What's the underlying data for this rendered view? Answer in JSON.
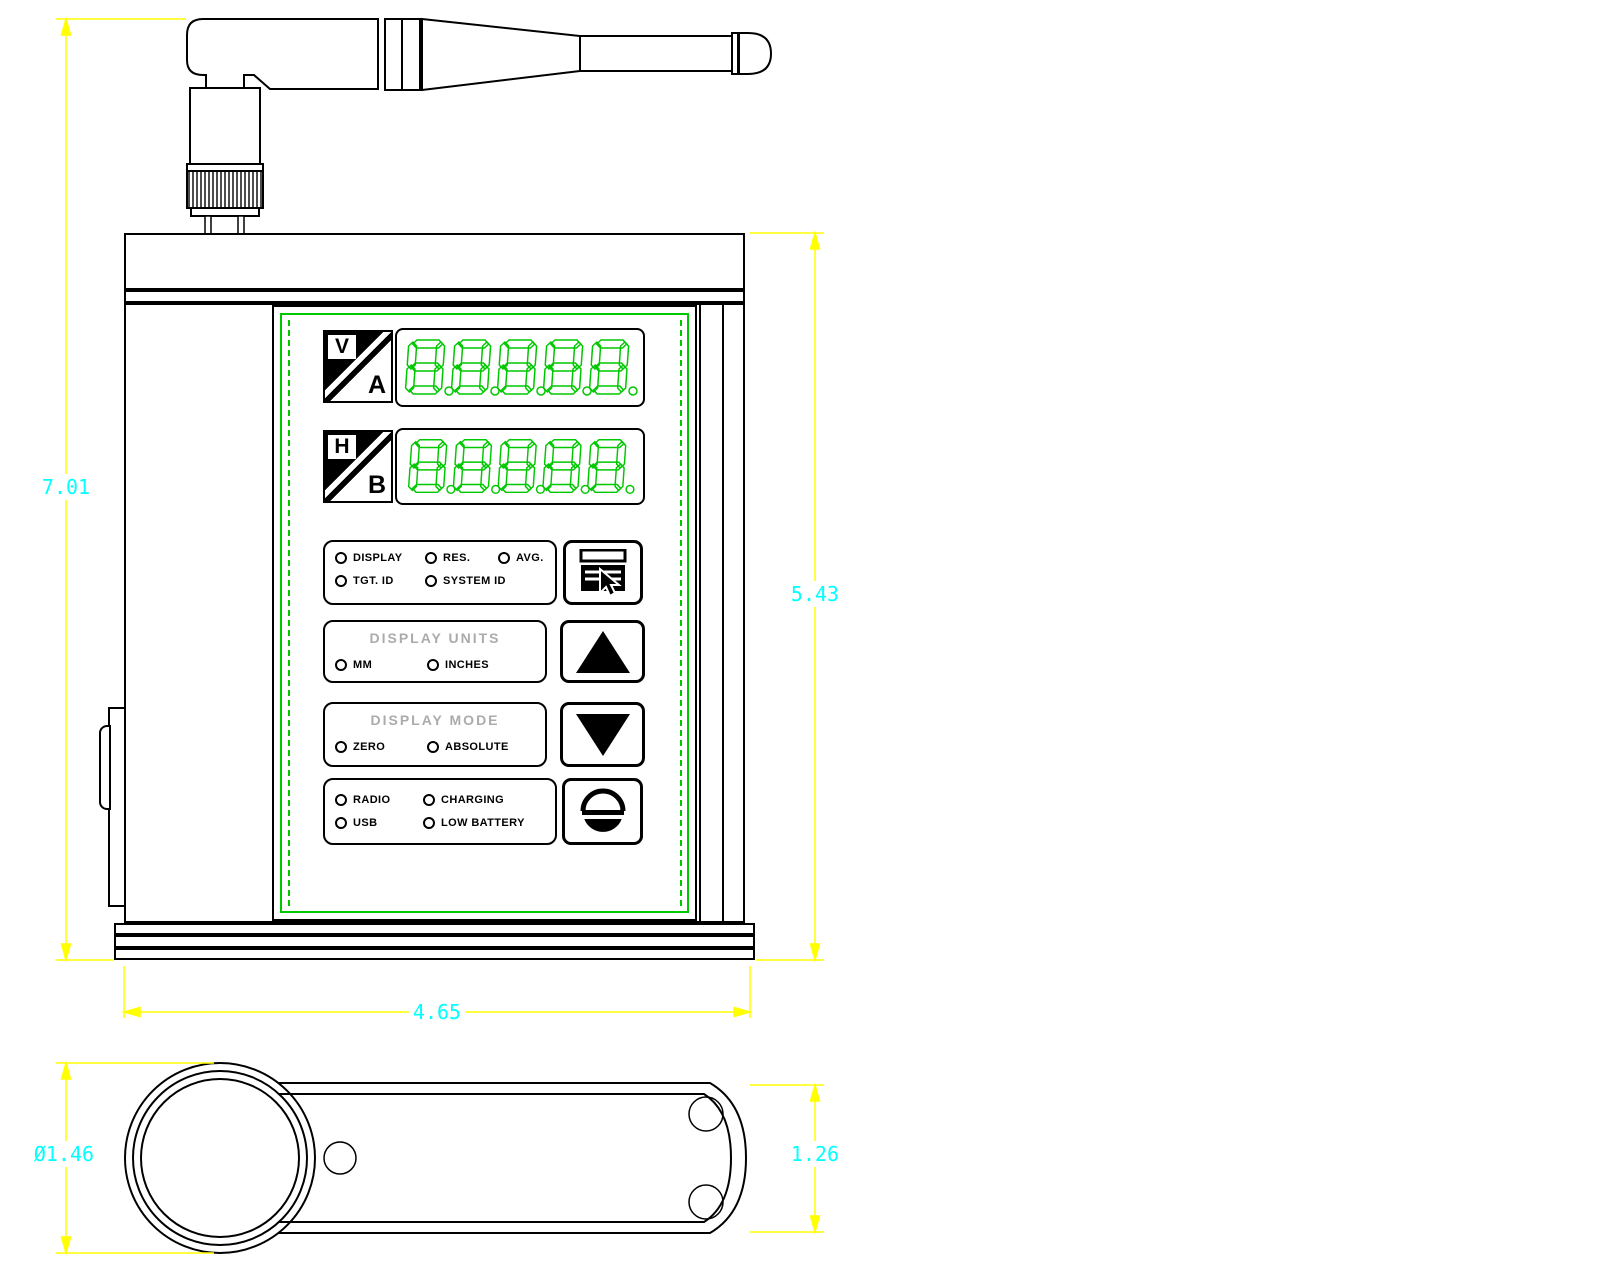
{
  "front_view": {
    "badge_va": {
      "top_letter": "V",
      "bottom_letter": "A"
    },
    "badge_hb": {
      "top_letter": "H",
      "bottom_letter": "B"
    },
    "display_a": {
      "digits": "8.8.8.8.8."
    },
    "display_b": {
      "digits": "8.8.8.8.8."
    },
    "menu_leds": {
      "display": "DISPLAY",
      "res": "RES.",
      "avg": "AVG.",
      "tgt_id": "TGT. ID",
      "system_id": "SYSTEM ID"
    },
    "units": {
      "title": "DISPLAY UNITS",
      "mm": "MM",
      "inches": "INCHES"
    },
    "mode": {
      "title": "DISPLAY MODE",
      "zero": "ZERO",
      "absolute": "ABSOLUTE"
    },
    "status": {
      "radio": "RADIO",
      "charging": "CHARGING",
      "usb": "USB",
      "low_battery": "LOW BATTERY"
    }
  },
  "dimensions": {
    "overall_height": "7.01",
    "body_height": "5.43",
    "body_width": "4.65",
    "knob_diameter": "Ø1.46",
    "base_depth": "1.26"
  },
  "colors": {
    "segment_green": "#00c800",
    "panel_frame_green": "#00c800",
    "dimension_line_yellow": "#ffff00",
    "dimension_text_cyan": "#00ffff",
    "outline_black": "#000000",
    "muted_title_gray": "#ababab"
  }
}
